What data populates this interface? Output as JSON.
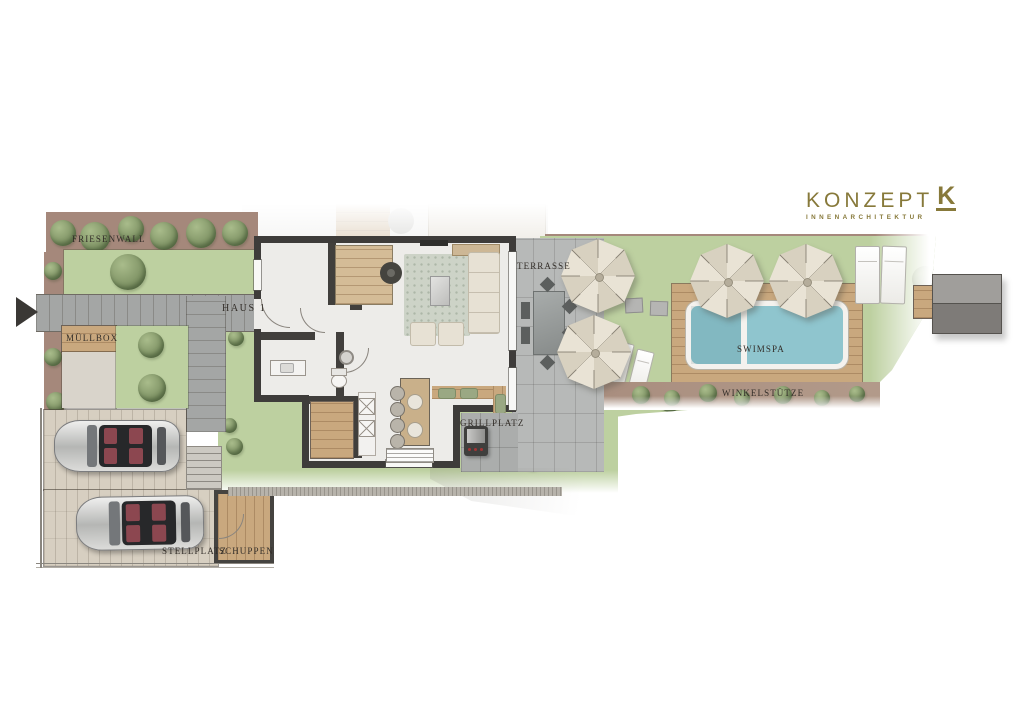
{
  "page": {
    "width": 1024,
    "height": 724,
    "background": "#ffffff"
  },
  "logo": {
    "brand": "KONZEPT",
    "mark": "K",
    "subtitle": "INNENARCHITEKTUR",
    "color": "#87793a"
  },
  "plan": {
    "labels": {
      "friesenwall": "FRIESENWALL",
      "haus": "HAUS 1",
      "muellbox": "MÜLLBOX",
      "terrasse": "TERRASSE",
      "swimspa": "SWIMSPA",
      "grillplatz": "GRILLPLATZ",
      "winkelstuetze": "WINKELSTÜTZE",
      "stellplatz": "STELLPLATZ",
      "schuppen": "SCHUPPEN"
    },
    "colors": {
      "label_ink": "#332e29",
      "lawn_green": "#bdd0a0",
      "foliage_green": "#7d9163",
      "hedge_ground_brown": "#a5887b",
      "paving_gray": "#a4a6a5",
      "terrace_gray": "#b7b9b8",
      "deck_wood": "#c9a87e",
      "spa_water_blue": "#8fc5ce",
      "house_wall_dark": "#3e3c3a",
      "interior_floor": "#edece9",
      "parking_beige": "#d7cfc1",
      "car_seat_red": "#8c4750"
    }
  }
}
